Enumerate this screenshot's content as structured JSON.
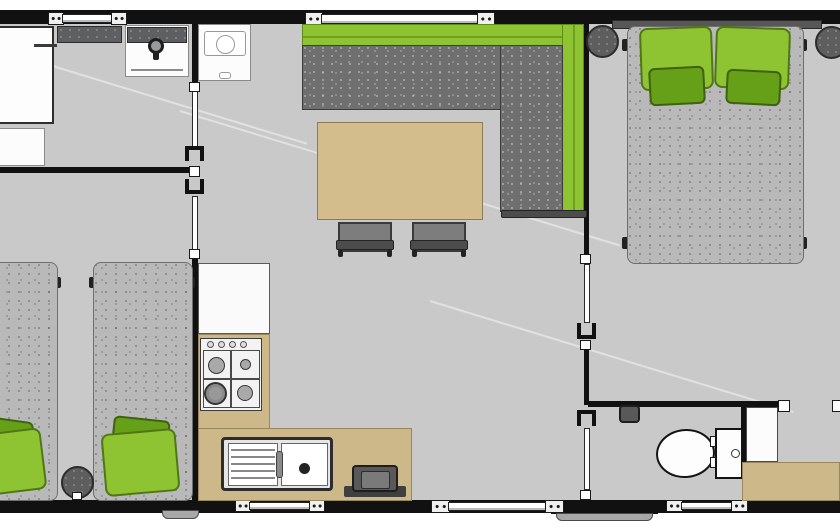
{
  "meta": {
    "view": "mobile-home-floorplan",
    "canvas": {
      "w": 840,
      "h": 530
    }
  },
  "palette": {
    "wall": "#111111",
    "floor": "#c9c9c9",
    "exterior": "#ffffff",
    "green": "#8ec431",
    "green_dark": "#65a018",
    "tan": "#cdb88a",
    "table": "#d3bd8c",
    "sofa_gray": "#6f6f6f",
    "mattress_gray": "#b9b9b9",
    "counter_dark": "#5d5f61"
  },
  "elements": [
    {
      "n": "floor",
      "c": "floor",
      "x": 0,
      "y": 10,
      "w": 840,
      "h": 503
    },
    {
      "n": "floor-seam",
      "c": "seam",
      "x": 20,
      "y": 55,
      "w": 300,
      "h": 2,
      "r": 17
    },
    {
      "n": "floor-seam",
      "c": "seam",
      "x": 180,
      "y": 110,
      "w": 460,
      "h": 2,
      "r": 17
    },
    {
      "n": "floor-seam",
      "c": "seam",
      "x": 430,
      "y": 300,
      "w": 380,
      "h": 2,
      "r": 17
    },
    {
      "n": "top-wall",
      "c": "wall",
      "x": 0,
      "y": 10,
      "w": 840,
      "h": 14
    },
    {
      "n": "bottom-wall",
      "c": "wall",
      "x": 0,
      "y": 500,
      "w": 840,
      "h": 13
    },
    {
      "n": "entry-step-edge",
      "c": "wall",
      "x": 551,
      "y": 508,
      "w": 107,
      "h": 6
    },
    {
      "n": "entry-step",
      "c": "step",
      "x": 556,
      "y": 513,
      "w": 97,
      "h": 8
    },
    {
      "n": "side-step",
      "c": "step",
      "x": 162,
      "y": 510,
      "w": 37,
      "h": 9
    },
    {
      "n": "bathroom-divider-wall",
      "c": "wall",
      "x": 0,
      "y": 167,
      "w": 197,
      "h": 6
    },
    {
      "n": "kitchen-divider-wall-upper",
      "c": "wall",
      "x": 192,
      "y": 24,
      "w": 6,
      "h": 64
    },
    {
      "n": "kitchen-divider-wall-lower",
      "c": "wall",
      "x": 192,
      "y": 256,
      "w": 6,
      "h": 244
    },
    {
      "n": "bedroom-divider-wall-upper",
      "c": "wall",
      "x": 584,
      "y": 24,
      "w": 5,
      "h": 233
    },
    {
      "n": "bedroom-divider-wall-mid",
      "c": "wall",
      "x": 584,
      "y": 348,
      "w": 5,
      "h": 57
    },
    {
      "n": "wc-wall-top",
      "c": "wall",
      "x": 588,
      "y": 401,
      "w": 197,
      "h": 6
    },
    {
      "n": "wc-wall-right",
      "c": "wall",
      "x": 741,
      "y": 405,
      "w": 5,
      "h": 58
    },
    {
      "n": "window-1-bracket-left",
      "c": "win-bracket",
      "x": 48,
      "y": 12,
      "w": 16,
      "h": 13
    },
    {
      "n": "window-1-pane",
      "c": "win-pane",
      "x": 62,
      "y": 14,
      "w": 52,
      "h": 9
    },
    {
      "n": "window-1-bracket-right",
      "c": "win-bracket",
      "x": 111,
      "y": 12,
      "w": 16,
      "h": 13
    },
    {
      "n": "window-2-bracket-left",
      "c": "win-bracket",
      "x": 305,
      "y": 12,
      "w": 18,
      "h": 14
    },
    {
      "n": "window-2-pane",
      "c": "win-pane",
      "x": 321,
      "y": 14,
      "w": 158,
      "h": 10
    },
    {
      "n": "window-2-bracket-right",
      "c": "win-bracket",
      "x": 477,
      "y": 12,
      "w": 18,
      "h": 14
    },
    {
      "n": "window-3-bracket-left",
      "c": "win-bracket",
      "x": 235,
      "y": 500,
      "w": 16,
      "h": 12
    },
    {
      "n": "window-3-pane",
      "c": "win-pane",
      "x": 249,
      "y": 502,
      "w": 62,
      "h": 8
    },
    {
      "n": "window-3-bracket-right",
      "c": "win-bracket",
      "x": 309,
      "y": 500,
      "w": 16,
      "h": 12
    },
    {
      "n": "window-4-bracket-left",
      "c": "win-bracket",
      "x": 431,
      "y": 500,
      "w": 19,
      "h": 13
    },
    {
      "n": "window-4-pane",
      "c": "win-pane",
      "x": 448,
      "y": 502,
      "w": 99,
      "h": 9
    },
    {
      "n": "window-4-bracket-right",
      "c": "win-bracket",
      "x": 545,
      "y": 500,
      "w": 19,
      "h": 13
    },
    {
      "n": "window-5-bracket-left",
      "c": "win-bracket",
      "x": 666,
      "y": 500,
      "w": 17,
      "h": 12
    },
    {
      "n": "window-5-pane",
      "c": "win-pane",
      "x": 681,
      "y": 502,
      "w": 52,
      "h": 8
    },
    {
      "n": "window-5-bracket-right",
      "c": "win-bracket",
      "x": 731,
      "y": 500,
      "w": 17,
      "h": 12
    },
    {
      "n": "bathroom-sliding-door",
      "c": "door-leaf",
      "x": 192,
      "y": 90,
      "w": 6,
      "h": 58
    },
    {
      "n": "bathroom-door-handle",
      "c": "handle",
      "x": 189,
      "y": 82,
      "w": 11,
      "h": 10
    },
    {
      "n": "bathroom-door-pocket",
      "c": "pocket cap-top",
      "x": 185,
      "y": 146,
      "w": 19,
      "h": 15
    },
    {
      "n": "wall-junction-connector",
      "c": "handle",
      "x": 189,
      "y": 166,
      "w": 11,
      "h": 11
    },
    {
      "n": "twin-room-door-pocket",
      "c": "pocket cap-bottom",
      "x": 185,
      "y": 179,
      "w": 19,
      "h": 15
    },
    {
      "n": "twin-room-sliding-door",
      "c": "door-leaf",
      "x": 192,
      "y": 196,
      "w": 6,
      "h": 56
    },
    {
      "n": "twin-room-door-handle",
      "c": "handle",
      "x": 189,
      "y": 249,
      "w": 11,
      "h": 10
    },
    {
      "n": "bedroom-door-handle-top",
      "c": "handle",
      "x": 580,
      "y": 254,
      "w": 11,
      "h": 10
    },
    {
      "n": "bedroom-sliding-door",
      "c": "door-leaf",
      "x": 584,
      "y": 264,
      "w": 6,
      "h": 59
    },
    {
      "n": "bedroom-door-pocket",
      "c": "pocket cap-bottom",
      "x": 577,
      "y": 323,
      "w": 19,
      "h": 16
    },
    {
      "n": "bedroom-door-handle-bottom",
      "c": "handle",
      "x": 580,
      "y": 340,
      "w": 11,
      "h": 10
    },
    {
      "n": "wc-door-pocket",
      "c": "pocket cap-top",
      "x": 577,
      "y": 410,
      "w": 19,
      "h": 16
    },
    {
      "n": "wc-sliding-door",
      "c": "door-leaf",
      "x": 584,
      "y": 428,
      "w": 6,
      "h": 62
    },
    {
      "n": "wc-door-handle",
      "c": "handle",
      "x": 580,
      "y": 490,
      "w": 11,
      "h": 10
    },
    {
      "n": "wc-opening-connector-left",
      "c": "handle",
      "x": 778,
      "y": 400,
      "w": 12,
      "h": 12
    },
    {
      "n": "wc-opening-connector-right",
      "c": "handle",
      "x": 832,
      "y": 400,
      "w": 12,
      "h": 12
    },
    {
      "n": "wardrobe",
      "c": "cabinet",
      "x": -3,
      "y": 26,
      "w": 57,
      "h": 98
    },
    {
      "n": "wardrobe-rail",
      "c": "dark-line",
      "x": 34,
      "y": 44,
      "w": 23,
      "h": 3
    },
    {
      "n": "storage-cabinet",
      "c": "cabinet-light",
      "x": -3,
      "y": 128,
      "w": 48,
      "h": 38
    },
    {
      "n": "bathroom-counter",
      "c": "counter-dark",
      "x": 57,
      "y": 26,
      "w": 65,
      "h": 17
    },
    {
      "n": "washbasin-unit",
      "c": "cabinet-light",
      "x": 125,
      "y": 25,
      "w": 64,
      "h": 52
    },
    {
      "n": "washbasin-backsplash",
      "c": "counter-dark",
      "x": 127,
      "y": 27,
      "w": 60,
      "h": 16
    },
    {
      "n": "washbasin-edge-line",
      "c": "gray-line",
      "x": 131,
      "y": 69,
      "w": 52,
      "h": 2
    },
    {
      "n": "washbasin-tap-ring",
      "c": "ring",
      "x": 148,
      "y": 38,
      "w": 16,
      "h": 16
    },
    {
      "n": "washbasin-tap-stem",
      "c": "dark-fill",
      "x": 153,
      "y": 51,
      "w": 6,
      "h": 9
    },
    {
      "n": "fridge",
      "c": "cabinet-light",
      "x": 198,
      "y": 24,
      "w": 53,
      "h": 57
    },
    {
      "n": "fridge-inner-panel",
      "c": "inner-rect",
      "x": 204,
      "y": 31,
      "w": 42,
      "h": 25
    },
    {
      "n": "fridge-dial",
      "c": "ring-light",
      "x": 216,
      "y": 35,
      "w": 19,
      "h": 19
    },
    {
      "n": "fridge-latch",
      "c": "inner-rect",
      "x": 219,
      "y": 72,
      "w": 12,
      "h": 7
    },
    {
      "n": "kitchen-worktop",
      "c": "worktop",
      "x": 198,
      "y": 263,
      "w": 72,
      "h": 71
    },
    {
      "n": "kitchen-counter-vertical",
      "c": "tan",
      "x": 198,
      "y": 334,
      "w": 72,
      "h": 95
    },
    {
      "n": "kitchen-counter-horizontal",
      "c": "tan",
      "x": 198,
      "y": 428,
      "w": 214,
      "h": 73
    },
    {
      "n": "stove",
      "c": "panel",
      "x": 200,
      "y": 338,
      "w": 62,
      "h": 73
    },
    {
      "n": "stove-knob",
      "c": "knob",
      "x": 207,
      "y": 341,
      "w": 7,
      "h": 7
    },
    {
      "n": "stove-knob",
      "c": "knob",
      "x": 218,
      "y": 341,
      "w": 7,
      "h": 7
    },
    {
      "n": "stove-knob",
      "c": "knob",
      "x": 229,
      "y": 341,
      "w": 7,
      "h": 7
    },
    {
      "n": "stove-knob",
      "c": "knob",
      "x": 240,
      "y": 341,
      "w": 7,
      "h": 7
    },
    {
      "n": "burner-grid",
      "c": "grid",
      "x": 203,
      "y": 350,
      "w": 57,
      "h": 58
    },
    {
      "n": "burner-grid-vline",
      "c": "grid-line",
      "x": 230,
      "y": 350,
      "w": 2,
      "h": 58
    },
    {
      "n": "burner-grid-hline",
      "c": "grid-line",
      "x": 203,
      "y": 378,
      "w": 57,
      "h": 2
    },
    {
      "n": "burner-top-left",
      "c": "burner",
      "x": 208,
      "y": 357,
      "w": 17,
      "h": 17
    },
    {
      "n": "burner-top-right",
      "c": "burner",
      "x": 240,
      "y": 359,
      "w": 11,
      "h": 11
    },
    {
      "n": "burner-bottom-left",
      "c": "burner-big",
      "x": 204,
      "y": 382,
      "w": 23,
      "h": 23
    },
    {
      "n": "burner-bottom-right",
      "c": "burner",
      "x": 237,
      "y": 385,
      "w": 16,
      "h": 16
    },
    {
      "n": "sink",
      "c": "sink-frame",
      "x": 221,
      "y": 437,
      "w": 112,
      "h": 54
    },
    {
      "n": "sink-drainboard",
      "c": "panel-white",
      "x": 228,
      "y": 443,
      "w": 50,
      "h": 43
    },
    {
      "n": "drainboard-line",
      "c": "drain-line",
      "x": 231,
      "y": 449,
      "w": 44,
      "h": 2
    },
    {
      "n": "drainboard-line",
      "c": "drain-line",
      "x": 231,
      "y": 456,
      "w": 44,
      "h": 2
    },
    {
      "n": "drainboard-line",
      "c": "drain-line",
      "x": 231,
      "y": 463,
      "w": 44,
      "h": 2
    },
    {
      "n": "drainboard-line",
      "c": "drain-line",
      "x": 231,
      "y": 470,
      "w": 44,
      "h": 2
    },
    {
      "n": "drainboard-line",
      "c": "drain-line",
      "x": 231,
      "y": 477,
      "w": 44,
      "h": 2
    },
    {
      "n": "sink-basin",
      "c": "panel-white",
      "x": 281,
      "y": 443,
      "w": 47,
      "h": 43
    },
    {
      "n": "sink-drain",
      "c": "dark-fill",
      "x": 299,
      "y": 463,
      "w": 11,
      "h": 11,
      "br": "50%"
    },
    {
      "n": "sink-faucet",
      "c": "faucet",
      "x": 276,
      "y": 451,
      "w": 7,
      "h": 27
    },
    {
      "n": "gas-unit-base",
      "c": "grill-base",
      "x": 344,
      "y": 486,
      "w": 62,
      "h": 11
    },
    {
      "n": "gas-unit",
      "c": "grill",
      "x": 352,
      "y": 465,
      "w": 46,
      "h": 27
    },
    {
      "n": "gas-unit-inner",
      "c": "grill-inner",
      "x": 361,
      "y": 471,
      "w": 29,
      "h": 18
    },
    {
      "n": "sofa-backrest-top",
      "c": "green",
      "x": 302,
      "y": 24,
      "w": 282,
      "h": 22
    },
    {
      "n": "sofa-backrest-top-line",
      "c": "green-line",
      "x": 303,
      "y": 36,
      "w": 280,
      "h": 2
    },
    {
      "n": "sofa-backrest-right",
      "c": "green",
      "x": 562,
      "y": 24,
      "w": 22,
      "h": 191
    },
    {
      "n": "sofa-backrest-right-line",
      "c": "green-line",
      "x": 573,
      "y": 25,
      "w": 2,
      "h": 189
    },
    {
      "n": "sofa-seat",
      "c": "speckle-dark",
      "x": 302,
      "y": 45,
      "w": 199,
      "h": 65
    },
    {
      "n": "sofa-chaise",
      "c": "speckle-dark",
      "x": 500,
      "y": 45,
      "w": 63,
      "h": 167
    },
    {
      "n": "sofa-armrest",
      "c": "armrest",
      "x": 501,
      "y": 210,
      "w": 86,
      "h": 8
    },
    {
      "n": "dining-table",
      "c": "table",
      "x": 317,
      "y": 122,
      "w": 166,
      "h": 98
    },
    {
      "n": "chair-1",
      "c": "chair",
      "x": 338,
      "y": 222,
      "w": 54,
      "h": 30
    },
    {
      "n": "chair-1-backrest",
      "c": "armrest",
      "x": 336,
      "y": 240,
      "w": 58,
      "h": 10
    },
    {
      "n": "chair-1-leg",
      "c": "dark-fill",
      "x": 338,
      "y": 250,
      "w": 5,
      "h": 7
    },
    {
      "n": "chair-1-leg",
      "c": "dark-fill",
      "x": 387,
      "y": 250,
      "w": 5,
      "h": 7
    },
    {
      "n": "chair-2",
      "c": "chair",
      "x": 412,
      "y": 222,
      "w": 54,
      "h": 30
    },
    {
      "n": "chair-2-backrest",
      "c": "armrest",
      "x": 410,
      "y": 240,
      "w": 58,
      "h": 10
    },
    {
      "n": "chair-2-leg",
      "c": "dark-fill",
      "x": 412,
      "y": 250,
      "w": 5,
      "h": 7
    },
    {
      "n": "chair-2-leg",
      "c": "dark-fill",
      "x": 461,
      "y": 250,
      "w": 5,
      "h": 7
    },
    {
      "n": "double-bed-headboard",
      "c": "armrest2",
      "x": 612,
      "y": 20,
      "w": 210,
      "h": 9
    },
    {
      "n": "double-bed-foot",
      "c": "dark-fill",
      "x": 622,
      "y": 39,
      "w": 7,
      "h": 12
    },
    {
      "n": "double-bed-foot",
      "c": "dark-fill",
      "x": 622,
      "y": 237,
      "w": 7,
      "h": 12
    },
    {
      "n": "double-bed-foot",
      "c": "dark-fill",
      "x": 800,
      "y": 39,
      "w": 7,
      "h": 12
    },
    {
      "n": "double-bed-foot",
      "c": "dark-fill",
      "x": 800,
      "y": 237,
      "w": 7,
      "h": 12
    },
    {
      "n": "double-bed",
      "c": "speckle-light",
      "x": 627,
      "y": 26,
      "w": 177,
      "h": 238,
      "br": "8px"
    },
    {
      "n": "pillow-left-large",
      "c": "pillow-light",
      "x": 640,
      "y": 27,
      "w": 73,
      "h": 63,
      "r": -2
    },
    {
      "n": "pillow-right-large",
      "c": "pillow-light",
      "x": 715,
      "y": 27,
      "w": 75,
      "h": 62,
      "r": 2
    },
    {
      "n": "pillow-left-small",
      "c": "pillow-dark",
      "x": 649,
      "y": 67,
      "w": 56,
      "h": 38,
      "r": -3
    },
    {
      "n": "pillow-right-small",
      "c": "pillow-dark",
      "x": 726,
      "y": 70,
      "w": 55,
      "h": 35,
      "r": 3
    },
    {
      "n": "nightstand-left",
      "c": "stool",
      "x": 586,
      "y": 25,
      "w": 33,
      "h": 33
    },
    {
      "n": "nightstand-right",
      "c": "stool",
      "x": 815,
      "y": 26,
      "w": 33,
      "h": 33
    },
    {
      "n": "twin-bed-left-foot",
      "c": "dark-fill",
      "x": 55,
      "y": 277,
      "w": 6,
      "h": 11
    },
    {
      "n": "twin-bed-left",
      "c": "speckle-light",
      "x": -44,
      "y": 262,
      "w": 102,
      "h": 239,
      "br": "8px"
    },
    {
      "n": "twin-bed-right-foot",
      "c": "dark-fill",
      "x": 89,
      "y": 277,
      "w": 6,
      "h": 11
    },
    {
      "n": "twin-bed-right-foot",
      "c": "dark-fill",
      "x": 189,
      "y": 277,
      "w": 6,
      "h": 11
    },
    {
      "n": "twin-bed-right",
      "c": "speckle-light",
      "x": 93,
      "y": 262,
      "w": 100,
      "h": 239,
      "br": "8px"
    },
    {
      "n": "twin-left-pillow-back",
      "c": "pillow-dark",
      "x": -16,
      "y": 419,
      "w": 48,
      "h": 38,
      "r": 8
    },
    {
      "n": "twin-left-pillow-front",
      "c": "pillow-light",
      "x": -24,
      "y": 431,
      "w": 68,
      "h": 62,
      "r": -7
    },
    {
      "n": "twin-right-pillow-back",
      "c": "pillow-dark",
      "x": 112,
      "y": 418,
      "w": 57,
      "h": 38,
      "r": 6
    },
    {
      "n": "twin-right-pillow-front",
      "c": "pillow-light",
      "x": 103,
      "y": 431,
      "w": 75,
      "h": 63,
      "r": -5
    },
    {
      "n": "bedside-stool",
      "c": "stool",
      "x": 61,
      "y": 466,
      "w": 33,
      "h": 33
    },
    {
      "n": "bedside-stool-detail",
      "c": "handle",
      "x": 72,
      "y": 492,
      "w": 10,
      "h": 8
    },
    {
      "n": "toilet-paper-holder",
      "c": "grill",
      "x": 619,
      "y": 405,
      "w": 21,
      "h": 18
    },
    {
      "n": "toilet-bowl",
      "c": "bowl",
      "x": 656,
      "y": 429,
      "w": 59,
      "h": 49,
      "r": -5
    },
    {
      "n": "toilet-hinge",
      "c": "handle",
      "x": 710,
      "y": 436,
      "w": 8,
      "h": 11
    },
    {
      "n": "toilet-hinge",
      "c": "handle",
      "x": 710,
      "y": 457,
      "w": 8,
      "h": 11
    },
    {
      "n": "toilet-cistern",
      "c": "bowl-rect",
      "x": 715,
      "y": 428,
      "w": 28,
      "h": 51
    },
    {
      "n": "toilet-flush-button",
      "c": "flush",
      "x": 731,
      "y": 449,
      "w": 9,
      "h": 9
    },
    {
      "n": "wc-open-door",
      "c": "door-panel",
      "x": 746,
      "y": 407,
      "w": 32,
      "h": 55
    },
    {
      "n": "wc-counter",
      "c": "tan",
      "x": 742,
      "y": 462,
      "w": 98,
      "h": 39
    }
  ]
}
